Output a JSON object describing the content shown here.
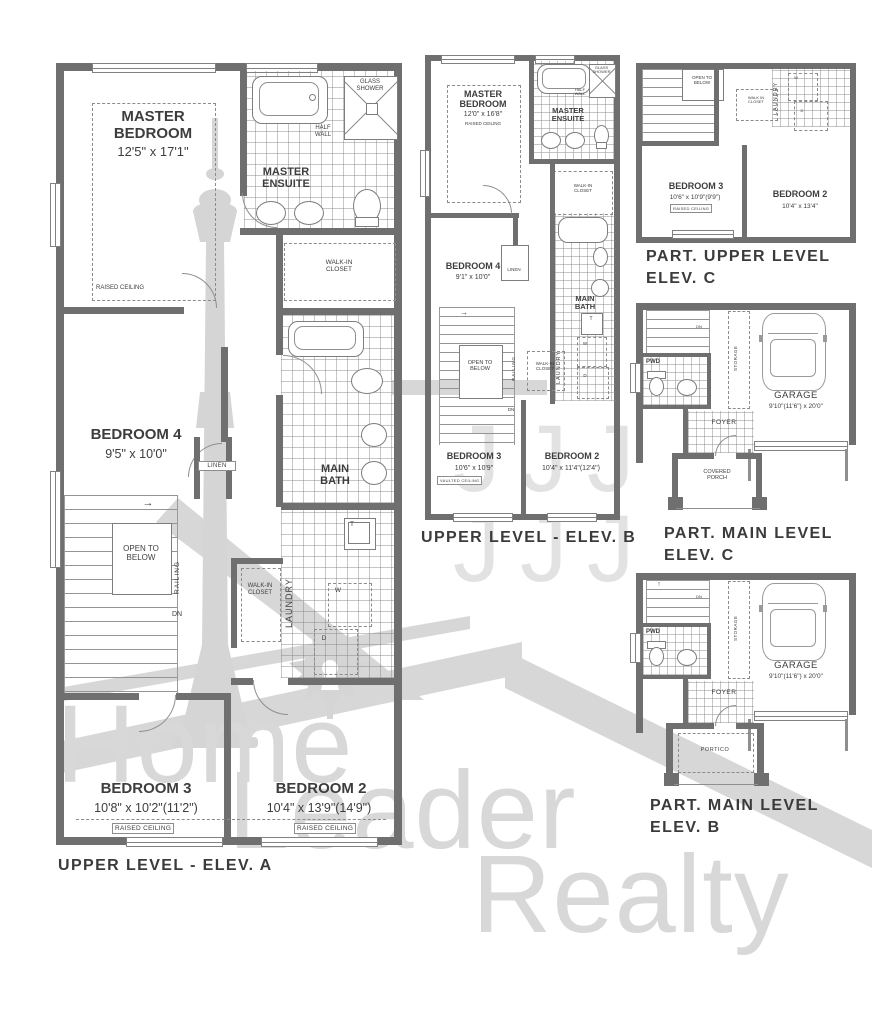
{
  "watermark": {
    "word1": "Home",
    "word2": "Leader",
    "word3": "Realty",
    "jmark": "J",
    "logo_icons": [
      "cn-tower",
      "maple-leaf",
      "keyhole",
      "roof-bands"
    ]
  },
  "colors": {
    "wall": "#6f6f6f",
    "line": "#8a8a8a",
    "text": "#3d3d3d",
    "wm": "#d8d8d8",
    "wm2": "#e2e2e2"
  },
  "shared": {
    "raised_ceiling": "RAISED CEILING",
    "vaulted_ceiling": "VAULTED CEILING",
    "open_to_below": "OPEN TO\nBELOW",
    "railing": "RAILING",
    "dn": "DN",
    "linen": "LINEN",
    "laundry": "LAUNDRY",
    "storage": "STORAGE",
    "walk_in_closet": "WALK-IN\nCLOSET",
    "walk_in_closet_alt": "WALK IN\nCLOSET",
    "glass_shower": "GLASS\nSHOWER",
    "half_wall": "HALF\nWALL",
    "master_ensuite": "MASTER\nENSUITE",
    "main_bath": "MAIN\nBATH",
    "pwd": "PWD",
    "foyer": "FOYER",
    "washer": "W",
    "dryer": "D",
    "laundry_tub": "T",
    "arrow_right": "→",
    "arrow_up": "↑"
  },
  "plan_a": {
    "caption": "UPPER LEVEL - ELEV. A",
    "master_name": "MASTER\nBEDROOM",
    "master_dims": "12'5\" x 17'1\"",
    "bed4_name": "BEDROOM 4",
    "bed4_dims": "9'5\" x 10'0\"",
    "bed3_name": "BEDROOM 3",
    "bed3_dims": "10'8\" x 10'2\"(11'2\")",
    "bed2_name": "BEDROOM 2",
    "bed2_dims": "10'4\" x 13'9\"(14'9\")"
  },
  "plan_b": {
    "caption": "UPPER LEVEL - ELEV. B",
    "master_name": "MASTER\nBEDROOM",
    "master_dims": "12'0\" x 16'8\"",
    "master_note": "RAISED CEILING",
    "bed4_name": "BEDROOM 4",
    "bed4_dims": "9'1\" x 10'0\"",
    "bed3_name": "BEDROOM 3",
    "bed3_dims": "10'6\" x 10'9\"",
    "bed3_note": "VAULTED CEILING",
    "bed2_name": "BEDROOM 2",
    "bed2_dims": "10'4\" x 11'4\"(12'4\")"
  },
  "plan_c_upper": {
    "caption": "PART. UPPER LEVEL\nELEV. C",
    "bed3_name": "BEDROOM 3",
    "bed3_dims": "10'6\" x 10'9\"(9'9\")",
    "bed2_name": "BEDROOM 2",
    "bed2_dims": "10'4\" x 13'4\""
  },
  "plan_c_main": {
    "caption": "PART. MAIN LEVEL\nELEV. C",
    "garage_name": "GARAGE",
    "garage_dims": "9'10\"(11'6\") x 20'0\"",
    "porch": "COVERED\nPORCH"
  },
  "plan_b_main": {
    "caption": "PART. MAIN LEVEL\nELEV. B",
    "garage_name": "GARAGE",
    "garage_dims": "9'10\"(11'6\") x 20'0\"",
    "portico": "PORTICO"
  }
}
